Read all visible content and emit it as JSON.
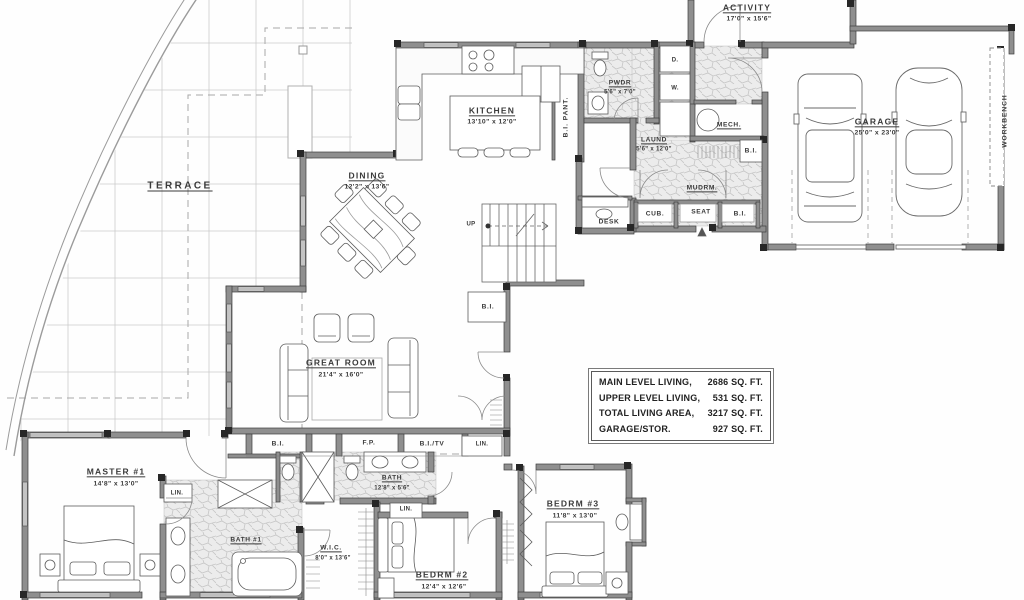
{
  "rooms": {
    "terrace": {
      "name": "TERRACE"
    },
    "kitchen": {
      "name": "KITCHEN",
      "dims": "13'10\" x 12'0\""
    },
    "dining": {
      "name": "DINING",
      "dims": "12'2\" x 13'6\""
    },
    "great_room": {
      "name": "GREAT ROOM",
      "dims": "21'4\" x 16'0\""
    },
    "activity": {
      "name": "ACTIVITY",
      "dims": "17'0\" x 15'6\""
    },
    "garage": {
      "name": "GARAGE",
      "dims": "25'0\" x 23'0\""
    },
    "pwdr": {
      "name": "PWDR",
      "dims": "5'6\" x 7'0\""
    },
    "laundry": {
      "name": "LAUND",
      "dims": "5'6\" x 12'0\""
    },
    "mudroom": {
      "name": "MUDRM."
    },
    "mech": {
      "name": "MECH."
    },
    "master": {
      "name": "MASTER #1",
      "dims": "14'8\" x 13'0\""
    },
    "bath1": {
      "name": "BATH #1"
    },
    "bath2": {
      "name": "BATH",
      "dims": "12'8\" x 5'6\""
    },
    "wic": {
      "name": "W.I.C.",
      "dims": "8'0\" x 13'6\""
    },
    "bedrm2": {
      "name": "BEDRM #2",
      "dims": "12'4\" x 12'6\""
    },
    "bedrm3": {
      "name": "BEDRM #3",
      "dims": "11'8\" x 13'0\""
    }
  },
  "features": {
    "bi_pant": "B.I. PANT.",
    "workbench": "WORKBENCH",
    "desk": "DESK",
    "cub": "CUB.",
    "seat": "SEAT",
    "bi": "B.I.",
    "bi_tv": "B.I./TV",
    "fp": "F.P.",
    "lin": "LIN.",
    "up": "UP",
    "dryer": "D.",
    "washer": "W."
  },
  "stats": {
    "rows": [
      {
        "label": "MAIN LEVEL LIVING,",
        "value": "2686 SQ. FT."
      },
      {
        "label": "UPPER LEVEL LIVING,",
        "value": "531 SQ. FT."
      },
      {
        "label": "TOTAL LIVING AREA,",
        "value": "3217 SQ. FT."
      },
      {
        "label": "GARAGE/STOR.",
        "value": "927 SQ. FT."
      }
    ]
  },
  "colors": {
    "wall": "#8f8f8f",
    "ink": "#3a3a3a",
    "tile": "#ececec",
    "grid": "#cbcbcb"
  }
}
